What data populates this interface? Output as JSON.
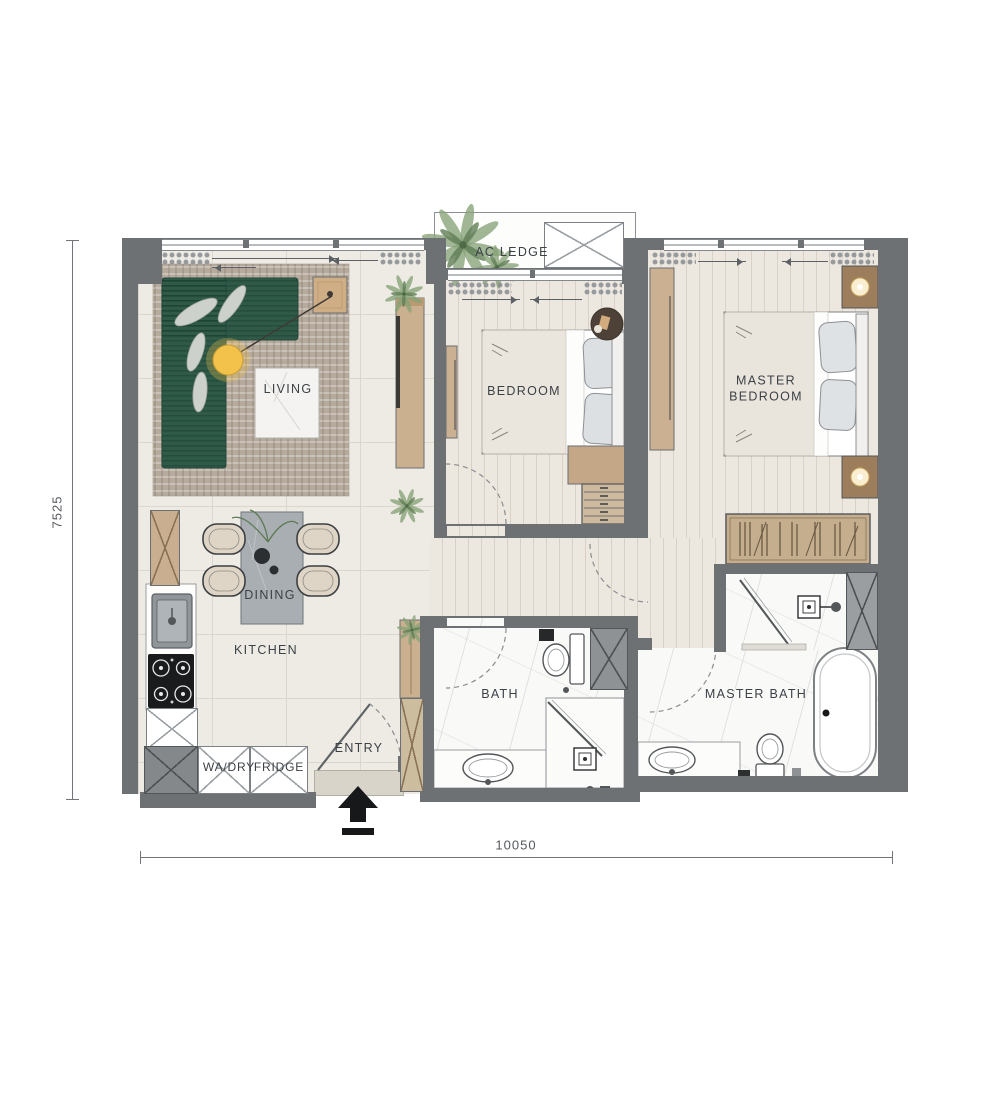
{
  "labels": {
    "living": "LIVING",
    "dining": "DINING",
    "kitchen": "KITCHEN",
    "entry": "ENTRY",
    "bath": "BATH",
    "master_bath": "MASTER BATH",
    "bedroom": "BEDROOM",
    "master_bedroom": "MASTER BEDROOM",
    "ac_ledge": "AC LEDGE",
    "washer_dryer": "WA/DRY",
    "fridge": "FRIDGE"
  },
  "dimensions": {
    "horizontal": "10050",
    "vertical": "7525"
  },
  "colors": {
    "wall": "#6e7174",
    "wall_dark": "#54575a",
    "floor_tile": "#edebe4",
    "tile_line": "#dcd7ce",
    "floor_wood": "#ece7df",
    "wood_line": "#d9d1c5",
    "floor_marble": "#f9f9f8",
    "rug": "#b5aa9c",
    "sofa": "#2f5a48",
    "wood_furniture": "#c9ae8f",
    "lamp": "#f2c24b",
    "plant": "#86a276",
    "arrow": "#17181a",
    "label_text": "#3c4147",
    "dim_text": "#55595e",
    "fixture_outline": "#55585b"
  }
}
